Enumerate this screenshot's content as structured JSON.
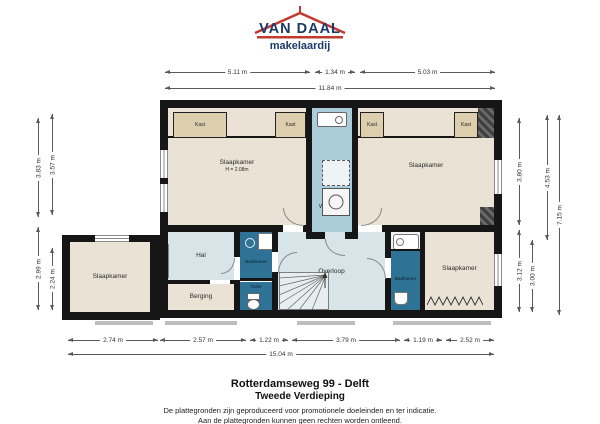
{
  "brand": {
    "name": "VAN DAAL",
    "tagline": "makelaardij",
    "color_navy": "#1d3a6d",
    "color_red": "#c23a2d"
  },
  "plan": {
    "rooms": {
      "bedroom_top_left": {
        "label": "Slaapkamer",
        "height_note": "H = 2.08m"
      },
      "bedroom_top_right": {
        "label": "Slaapkamer"
      },
      "bedroom_bottom_left": {
        "label": "Slaapkamer"
      },
      "bedroom_bottom_right": {
        "label": "Slaapkamer"
      },
      "laundry": {
        "label_line1": "Berging/",
        "label_line2": "Wasruimte"
      },
      "hall": {
        "label": "Hal"
      },
      "storage": {
        "label": "Berging"
      },
      "bathroom_left": {
        "label": "Badkamer"
      },
      "bathroom_right": {
        "label": "Badkamer"
      },
      "toilet": {
        "label": "Toilet"
      },
      "landing": {
        "label": "Overloop"
      },
      "closet_label": "Kast"
    },
    "dimensions": {
      "top_segments": [
        "5.11 m",
        "1.34 m",
        "5.03 m"
      ],
      "top_total": "11.84 m",
      "bottom_segments": [
        "2.74 m",
        "2.57 m",
        "1.22 m",
        "3.79 m",
        "1.19 m",
        "2.52 m"
      ],
      "bottom_total": "15.04 m",
      "left_outer": [
        "3.83 m",
        "2.99 m"
      ],
      "left_inner": [
        "3.57 m",
        "2.24 m"
      ],
      "right_col1": [
        "3.80 m",
        "3.12 m"
      ],
      "right_col2": "3.00 m",
      "right_col3": "4.53 m",
      "right_total": "7.15 m"
    },
    "palette": {
      "wall": "#161616",
      "room_beige": "#eae2d4",
      "closet_tan": "#ddcfae",
      "hall_blue": "#d7e5e9",
      "laundry_blue": "#abccd9",
      "bath_blue": "#2e7396"
    }
  },
  "footer": {
    "address": "Rotterdamseweg 99 - Delft",
    "floor": "Tweede Verdieping",
    "disclaimer_line1": "De plattegronden zijn geproduceerd voor promotionele doeleinden en ter indicatie.",
    "disclaimer_line2": "Aan de plattegronden kunnen geen rechten worden ontleend."
  }
}
